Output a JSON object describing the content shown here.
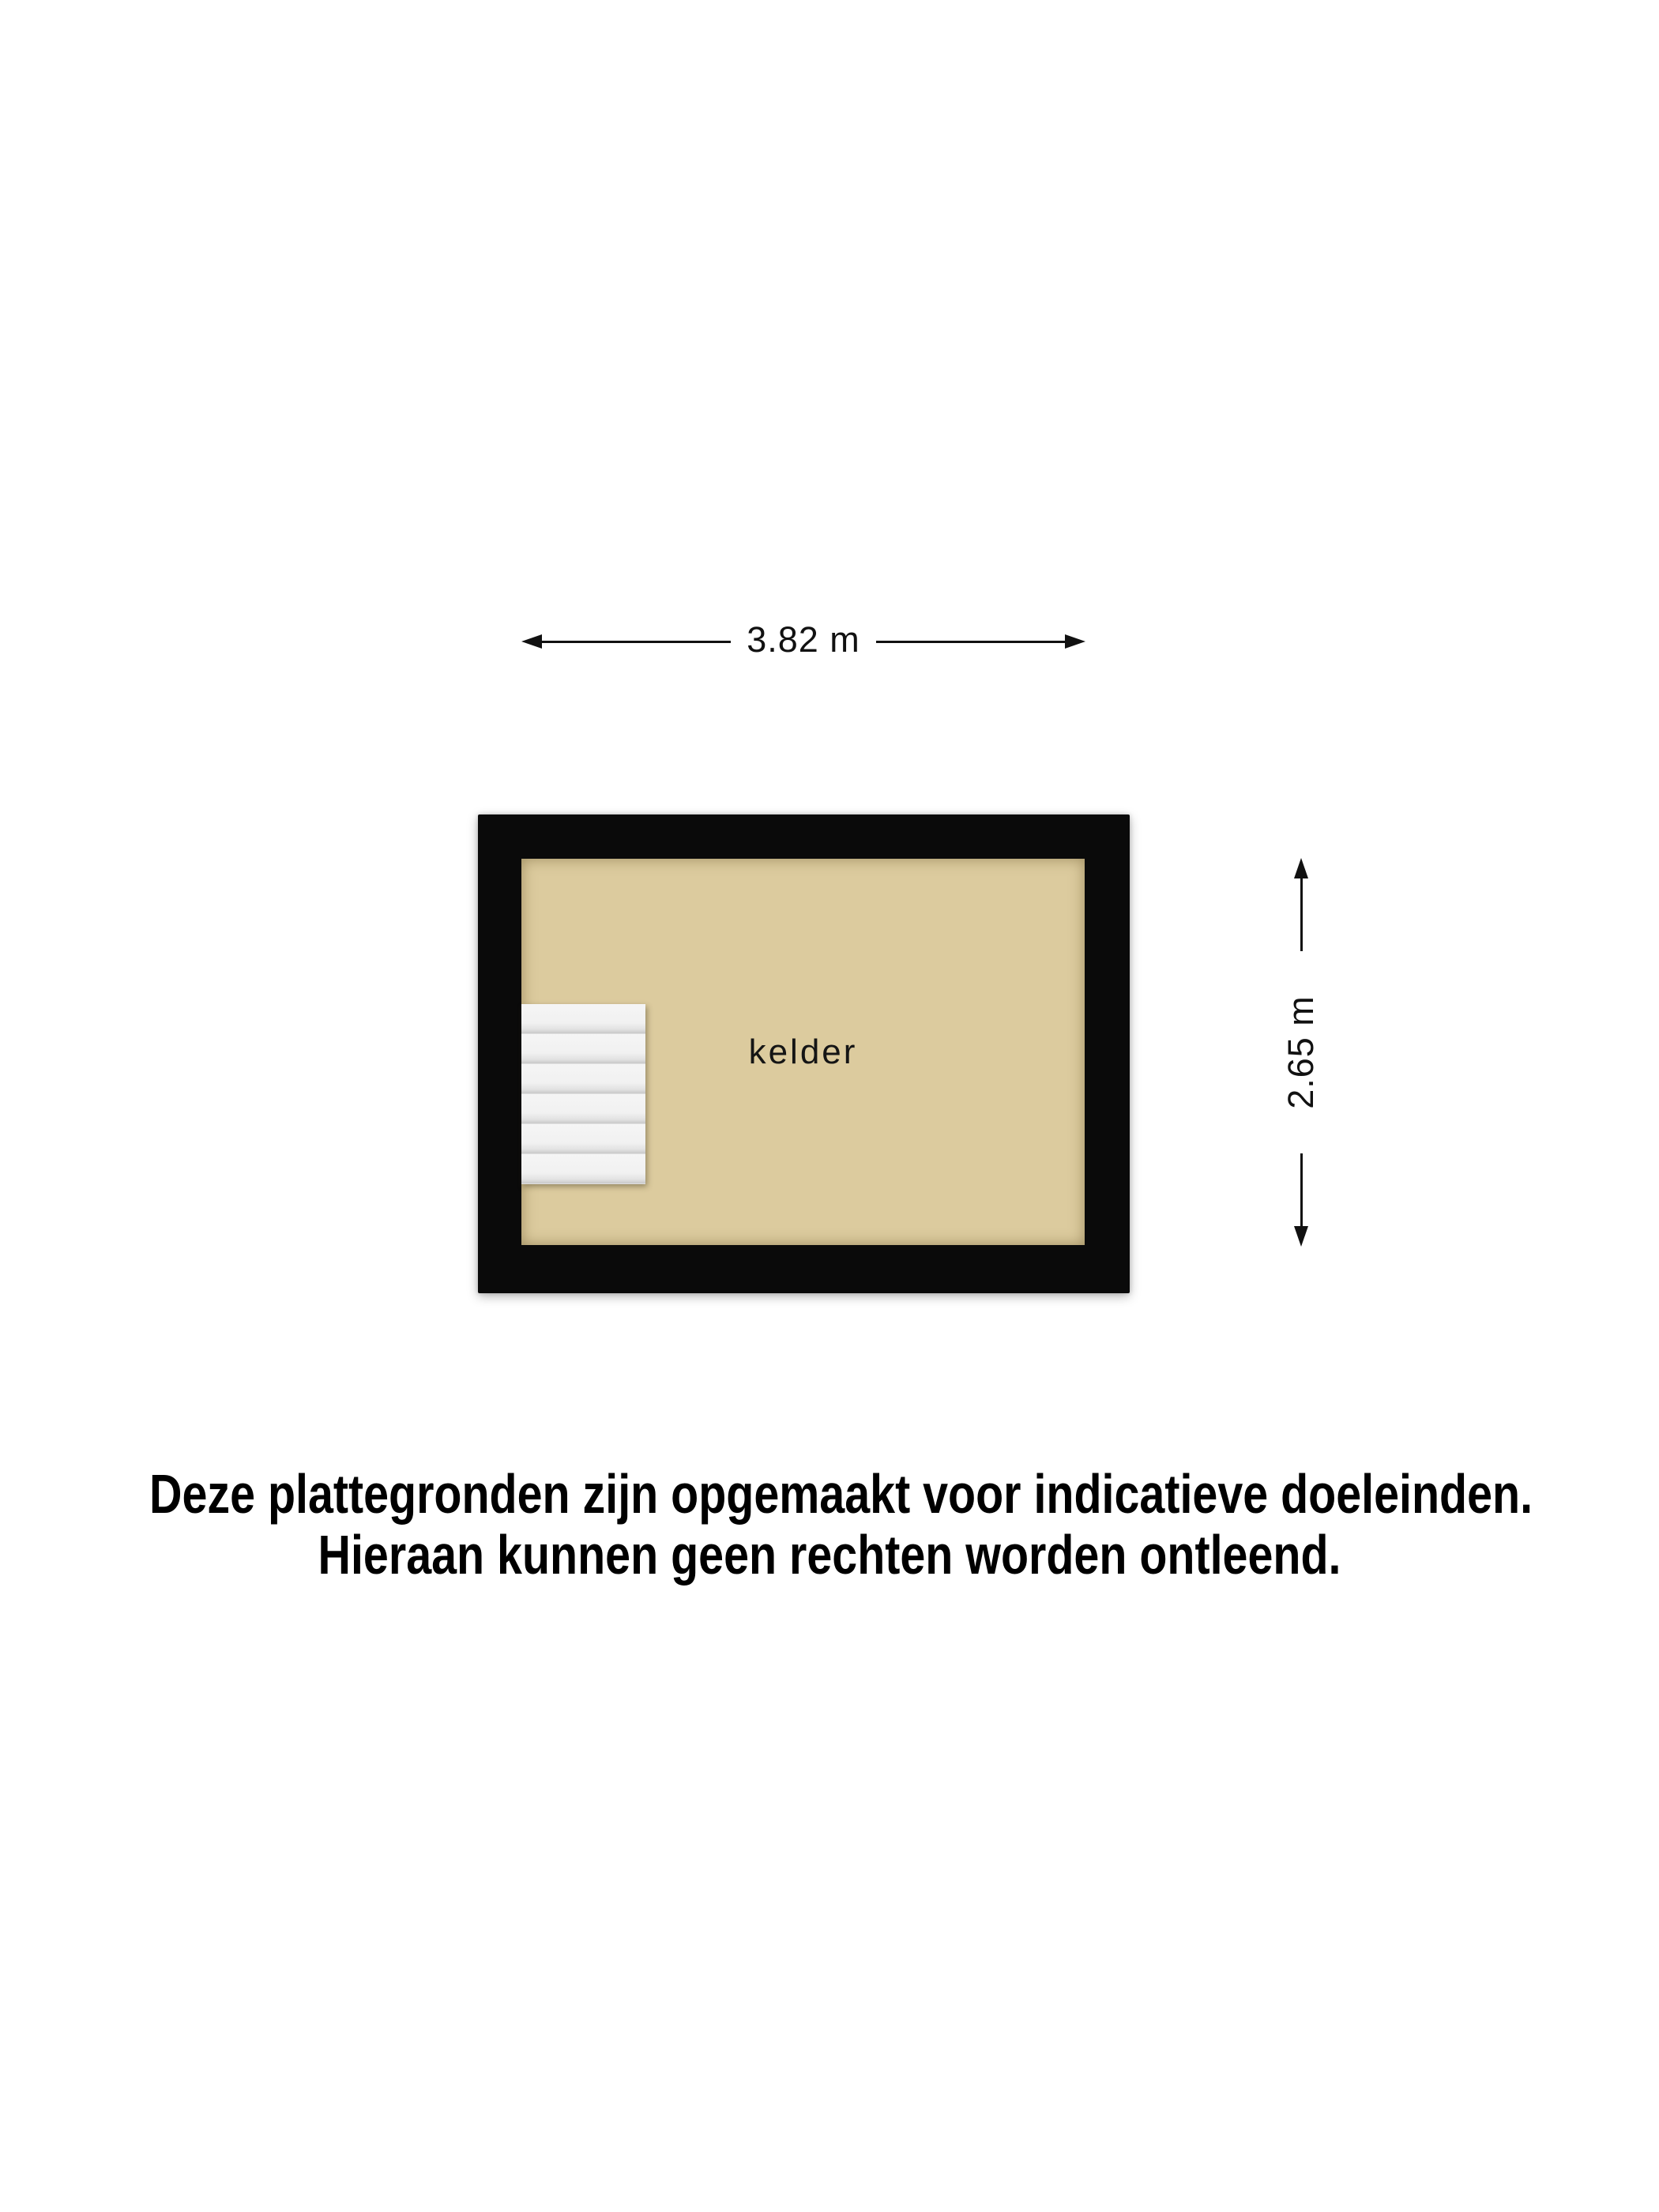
{
  "floorplan": {
    "room_label": "kelder",
    "width_dimension": "3.82 m",
    "height_dimension": "2.65 m",
    "stairs_steps": 6,
    "colors": {
      "wall": "#0a0a0a",
      "floor": "#dccb9e",
      "stairs": "#f3f3f3",
      "ink": "#111111",
      "bg": "#ffffff"
    }
  },
  "disclaimer": {
    "line1": "Deze plattegronden zijn opgemaakt voor indicatieve doeleinden.",
    "line2": "Hieraan kunnen geen rechten worden ontleend."
  }
}
